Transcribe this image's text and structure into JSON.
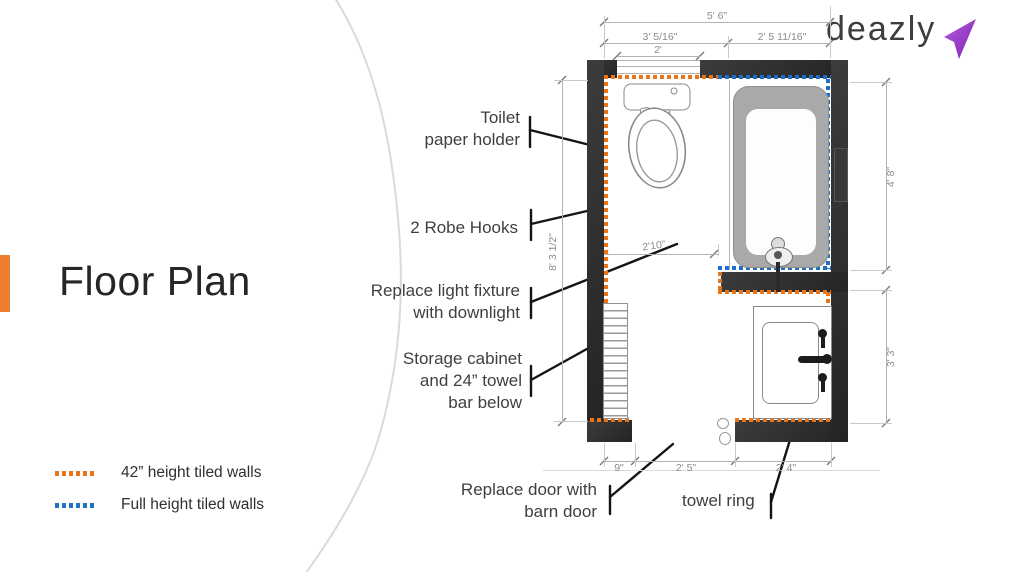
{
  "title": "Floor Plan",
  "logo": {
    "text": "deazly",
    "arrow_icon": "purple-swoosh-arrow"
  },
  "legend": {
    "items": [
      {
        "label": "42” height tiled walls",
        "color": "#e8751a",
        "style": "orange-dotted"
      },
      {
        "label": "Full height tiled walls",
        "color": "#2272c3",
        "style": "blue-dotted"
      }
    ]
  },
  "annotations": {
    "toilet_paper": "Toilet\npaper holder",
    "robe_hooks": "2 Robe Hooks",
    "light_fixture": "Replace light fixture\nwith downlight",
    "storage": "Storage cabinet\nand 24” towel\nbar below",
    "barn_door": "Replace door with\nbarn door",
    "towel_ring": "towel ring"
  },
  "dimensions": {
    "top_total": "5' 6\"",
    "top_left": "3' 5/16\"",
    "top_right": "2' 5 11/16\"",
    "window": "2'",
    "left_height": "8' 3 1/2\"",
    "right_upper": "4' 8\"",
    "right_lower": "3' 3\"",
    "bottom_left": "9\"",
    "bottom_middle": "2' 5\"",
    "bottom_right": "2' 4\"",
    "interior_width": "2'10\""
  },
  "colors": {
    "accent_orange": "#ED7D31",
    "tile_orange": "#e8751a",
    "tile_blue": "#2272c3",
    "wall": "#2e2e2e",
    "logo_purple": "#9b30d0"
  }
}
